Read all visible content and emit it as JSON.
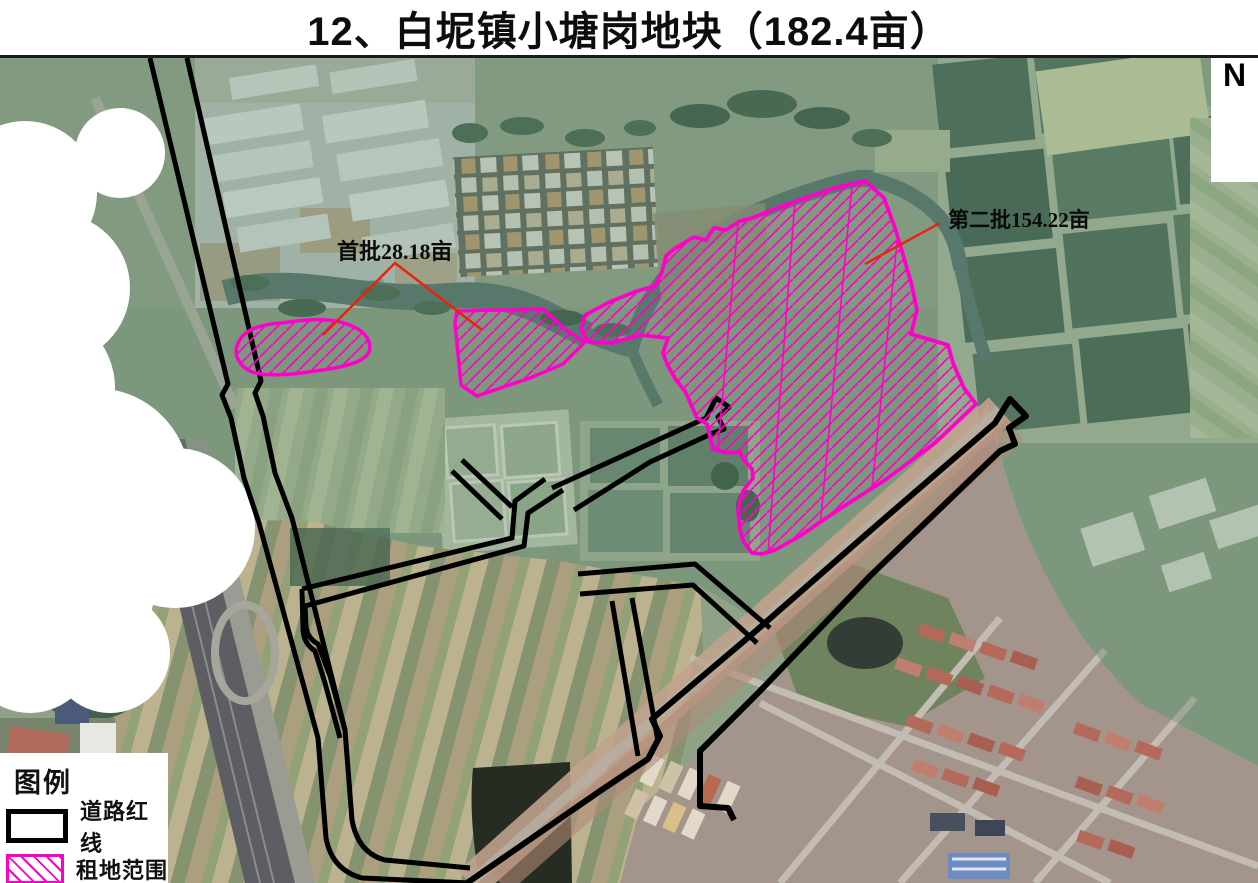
{
  "title": "12、白坭镇小塘岗地块（182.4亩）",
  "compass": {
    "label": "N"
  },
  "map": {
    "annotations": [
      {
        "id": "first-batch",
        "label": "首批28.18亩"
      },
      {
        "id": "second-batch",
        "label": "第二批154.22亩"
      }
    ]
  },
  "legend": {
    "title": "图例",
    "items": [
      {
        "id": "road-redline",
        "label": "道路红线"
      },
      {
        "id": "lease-area",
        "label": "租地范围"
      }
    ]
  },
  "colors": {
    "lease_outline": "#ff00cc",
    "road_line": "#000000",
    "leader_line": "#e8230a"
  }
}
